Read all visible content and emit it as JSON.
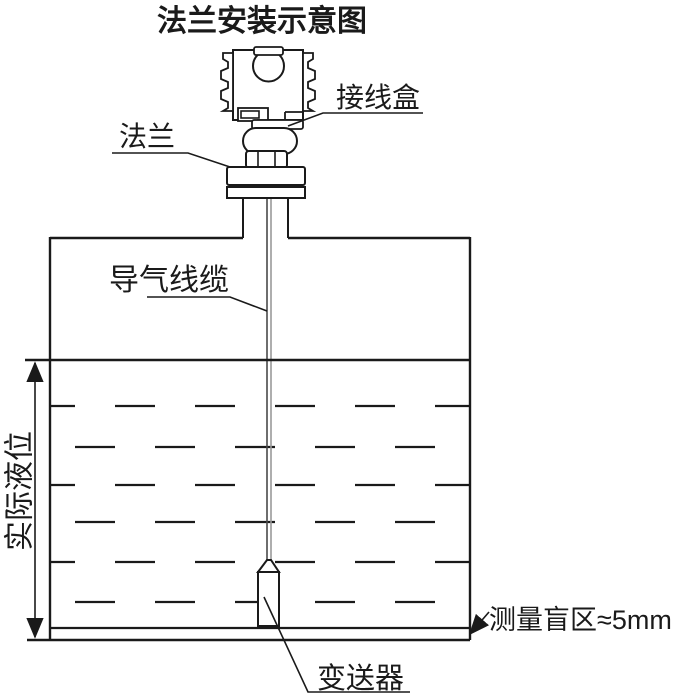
{
  "title": "法兰安装示意图",
  "labels": {
    "junction_box": "接线盒",
    "flange": "法兰",
    "vent_cable": "导气线缆",
    "actual_level": "实际液位",
    "transmitter": "变送器",
    "blind_zone": "测量盲区≈5mm"
  },
  "colors": {
    "ink": "#1a1a1a",
    "bg": "#ffffff",
    "cable_dark": "#4a4a4a",
    "cable_light": "#9a9a9a"
  }
}
